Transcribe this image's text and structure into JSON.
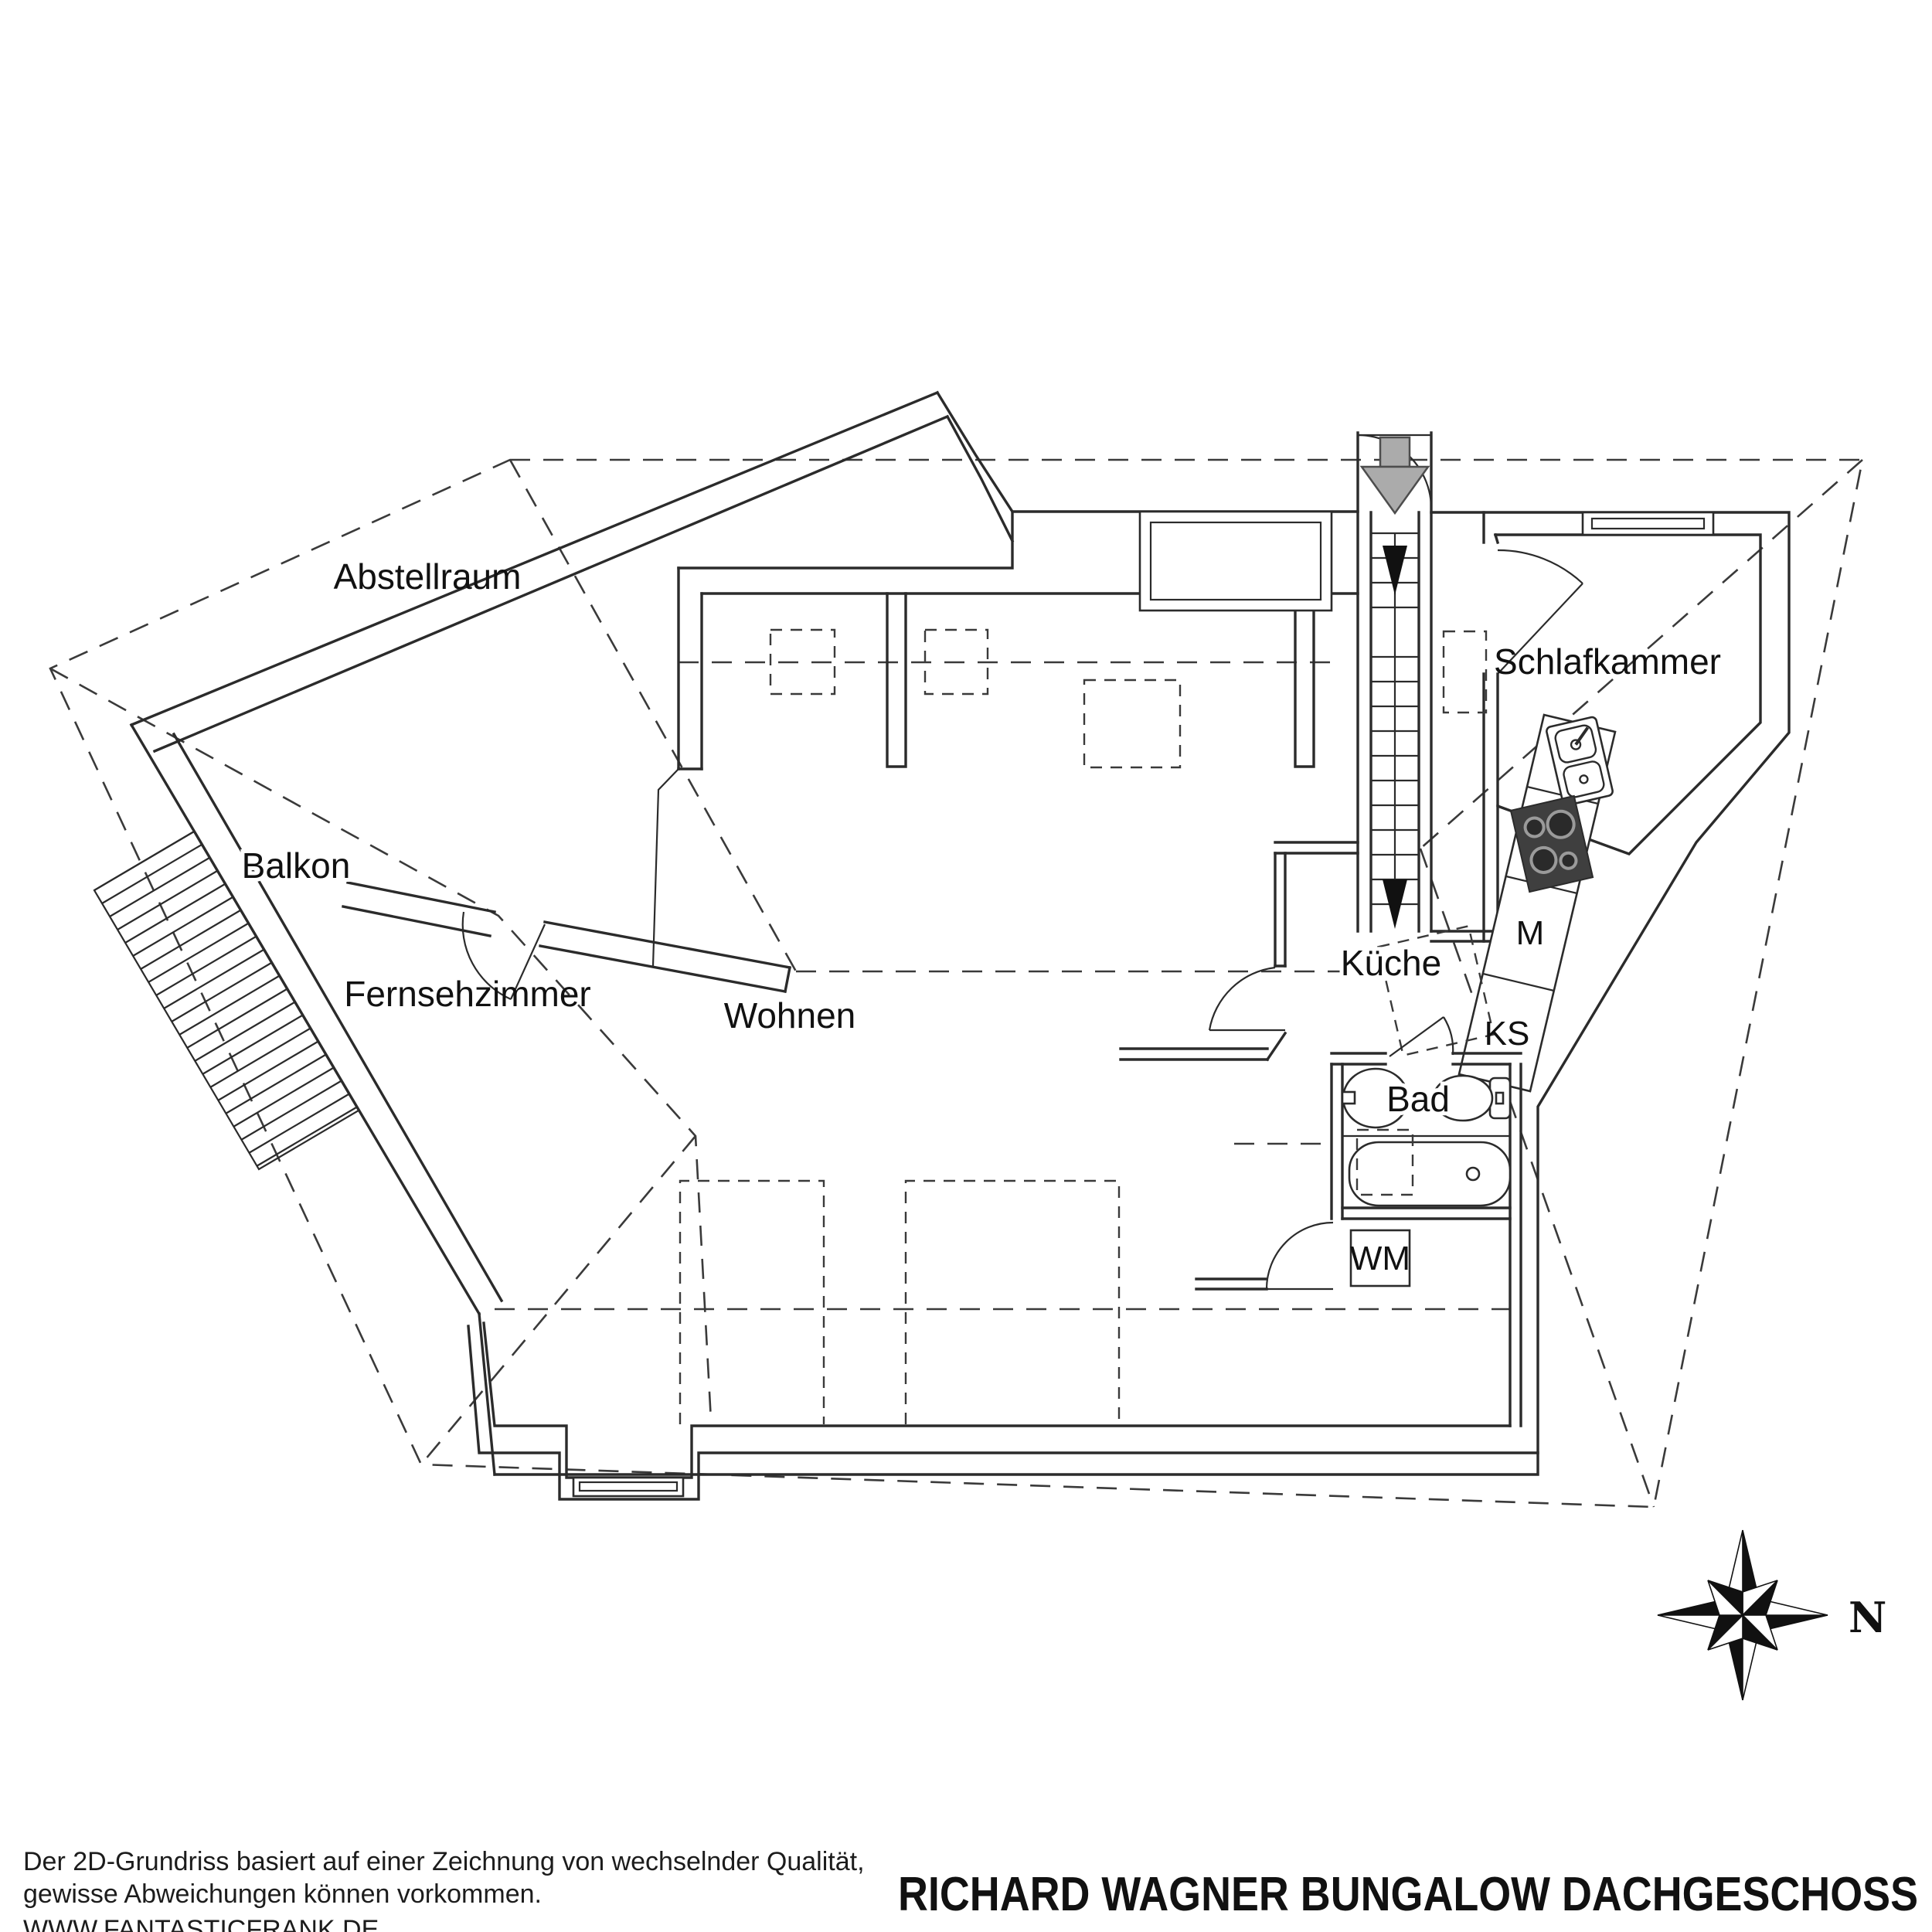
{
  "floorplan": {
    "title": "RICHARD WAGNER BUNGALOW DACHGESCHOSS",
    "disclaimer_line1": "Der 2D-Grundriss basiert auf einer Zeichnung von wechselnder Qualität,",
    "disclaimer_line2": "gewisse Abweichungen können vorkommen.",
    "website": "WWW.FANTASTICFRANK.DE",
    "compass_label": "N",
    "rooms": [
      {
        "id": "abstellraum",
        "label": "Abstellraum"
      },
      {
        "id": "schlafkammer",
        "label": "Schlafkammer"
      },
      {
        "id": "kueche",
        "label": "Küche"
      },
      {
        "id": "wohnen",
        "label": "Wohnen"
      },
      {
        "id": "fernsehzimmer",
        "label": "Fernsehzimmer"
      },
      {
        "id": "balkon",
        "label": "Balkon"
      },
      {
        "id": "bad",
        "label": "Bad"
      }
    ],
    "appliances": [
      {
        "id": "waschmaschine",
        "label": "WM"
      },
      {
        "id": "maschine",
        "label": "M"
      },
      {
        "id": "kuehlschrank",
        "label": "KS"
      }
    ],
    "colors": {
      "line": "#2b2b2b",
      "entry_arrow": "#ababab",
      "hob": "#3f3f3f",
      "background": "#ffffff"
    }
  }
}
